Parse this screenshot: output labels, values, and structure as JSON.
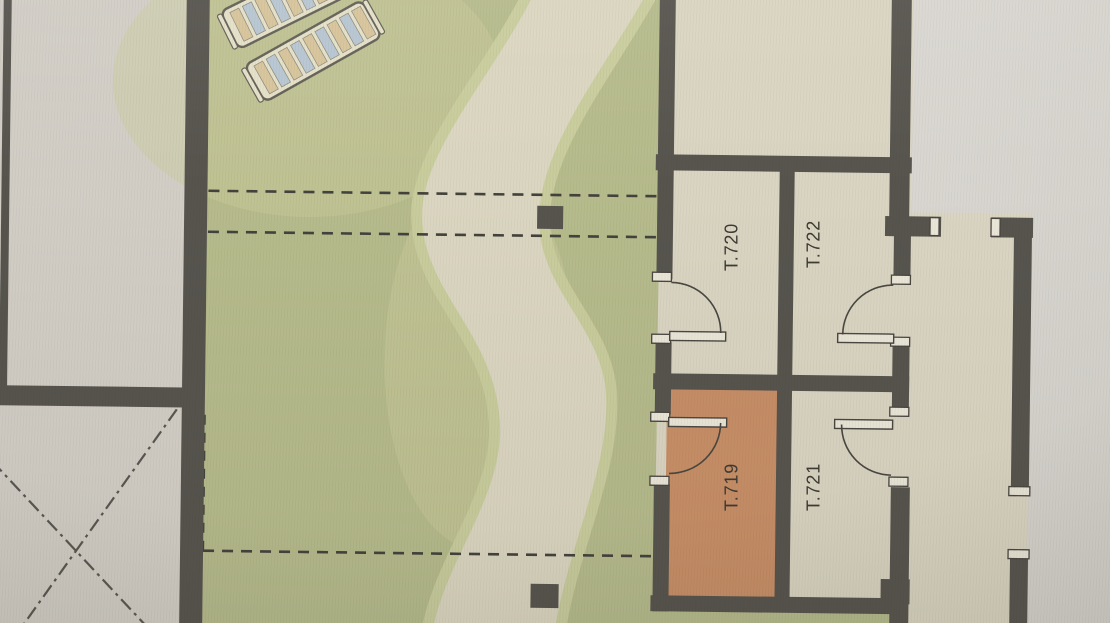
{
  "image": {
    "type": "floor-plan-photo",
    "description": "Photographed architectural floor plan: garden terrace with winding path and two sun loungers on the left, a block of four rooms on the right, room T.719 highlighted in orange, corridor along the right edge"
  },
  "plan": {
    "rooms": [
      {
        "id": "t720",
        "label": "T.720",
        "highlighted": false
      },
      {
        "id": "t722",
        "label": "T.722",
        "highlighted": false
      },
      {
        "id": "t719",
        "label": "T.719",
        "highlighted": true
      },
      {
        "id": "t721",
        "label": "T.721",
        "highlighted": false
      }
    ],
    "highlighted_room": "T.719",
    "features": {
      "sun_loungers": 2,
      "column_markers": 2,
      "door_swings": 4,
      "dashed_boundary_lines": 4,
      "diagonal_dashed_lines": 2
    },
    "colors": {
      "paper_left": "#d1cdc5",
      "paper_right": "#dad7d2",
      "lawn": "#b6bb8b",
      "lawn_light": "#c9cd9c",
      "path": "#dbd6c1",
      "floor": "#dad5c2",
      "highlight": "#c98f66",
      "wall": "#57544e",
      "line": "#4a4741",
      "dash": "#44423c",
      "cap": "#eae6d8",
      "label": "#3e3b34",
      "slat_yellow": "#d7c49a",
      "slat_blue": "#b7c6d2"
    }
  }
}
